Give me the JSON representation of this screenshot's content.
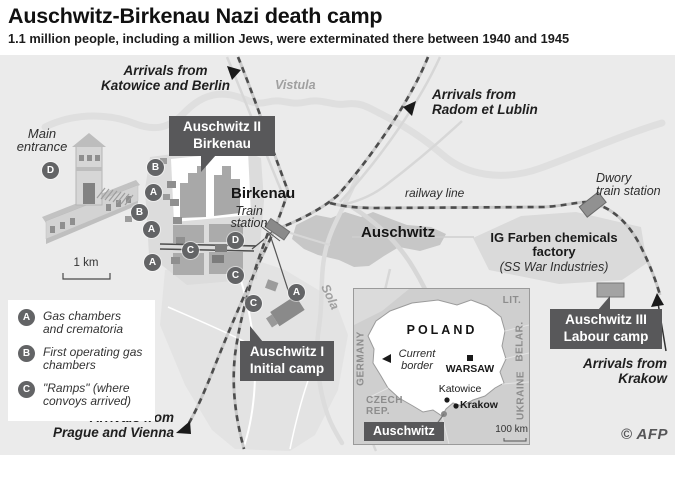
{
  "header": {
    "title": "Auschwitz-Birkenau Nazi death camp",
    "subtitle": "1.1 million people, including a million Jews, were exterminated there between 1940 and 1945"
  },
  "map": {
    "arrivals": {
      "katowice": "Arrivals from\nKatowice and Berlin",
      "radom": "Arrivals from\nRadom et Lublin",
      "prague": "Arrivals from\nPrague and Vienna",
      "krakow": "Arrivals from\nKrakow"
    },
    "rivers": {
      "vistula": "Vistula",
      "sola": "Sola"
    },
    "labels": {
      "main_entrance": "Main\nentrance",
      "birkenau": "Birkenau",
      "train_station": "Train\nstation",
      "auschwitz_town": "Auschwitz",
      "railway_line": "railway line",
      "dwory": "Dwory\ntrain station",
      "ig_farben": "IG Farben chemicals\nfactory",
      "ig_farben_sub": "(SS War Industries)",
      "scale": "1 km"
    },
    "callouts": {
      "auschwitz2": "Auschwitz II\nBirkenau",
      "auschwitz1": "Auschwitz I\nInitial camp",
      "auschwitz3": "Auschwitz III\nLabour camp"
    },
    "badge_letters": {
      "a": "A",
      "b": "B",
      "c": "C",
      "d": "D"
    },
    "legend": {
      "items": [
        {
          "badge": "A",
          "text": "Gas chambers\nand crematoria"
        },
        {
          "badge": "B",
          "text": "First operating gas\nchambers"
        },
        {
          "badge": "C",
          "text": "\"Ramps\" (where\nconvoys arrived)"
        }
      ]
    },
    "inset": {
      "country": "POLAND",
      "current_border": "Current\nborder",
      "warsaw": "WARSAW",
      "katowice": "Katowice",
      "krakow": "Krakow",
      "auschwitz": "Auschwitz",
      "germany": "GERMANY",
      "czech_rep": "CZECH\nREP.",
      "lit": "LIT.",
      "belarus": "BELAR.",
      "ukraine": "UKRAINE",
      "scale": "100 km"
    },
    "credit": "© AFP"
  },
  "colors": {
    "dark_box": "#58585a",
    "badge": "#636466",
    "map_bg": "#ebebeb"
  }
}
